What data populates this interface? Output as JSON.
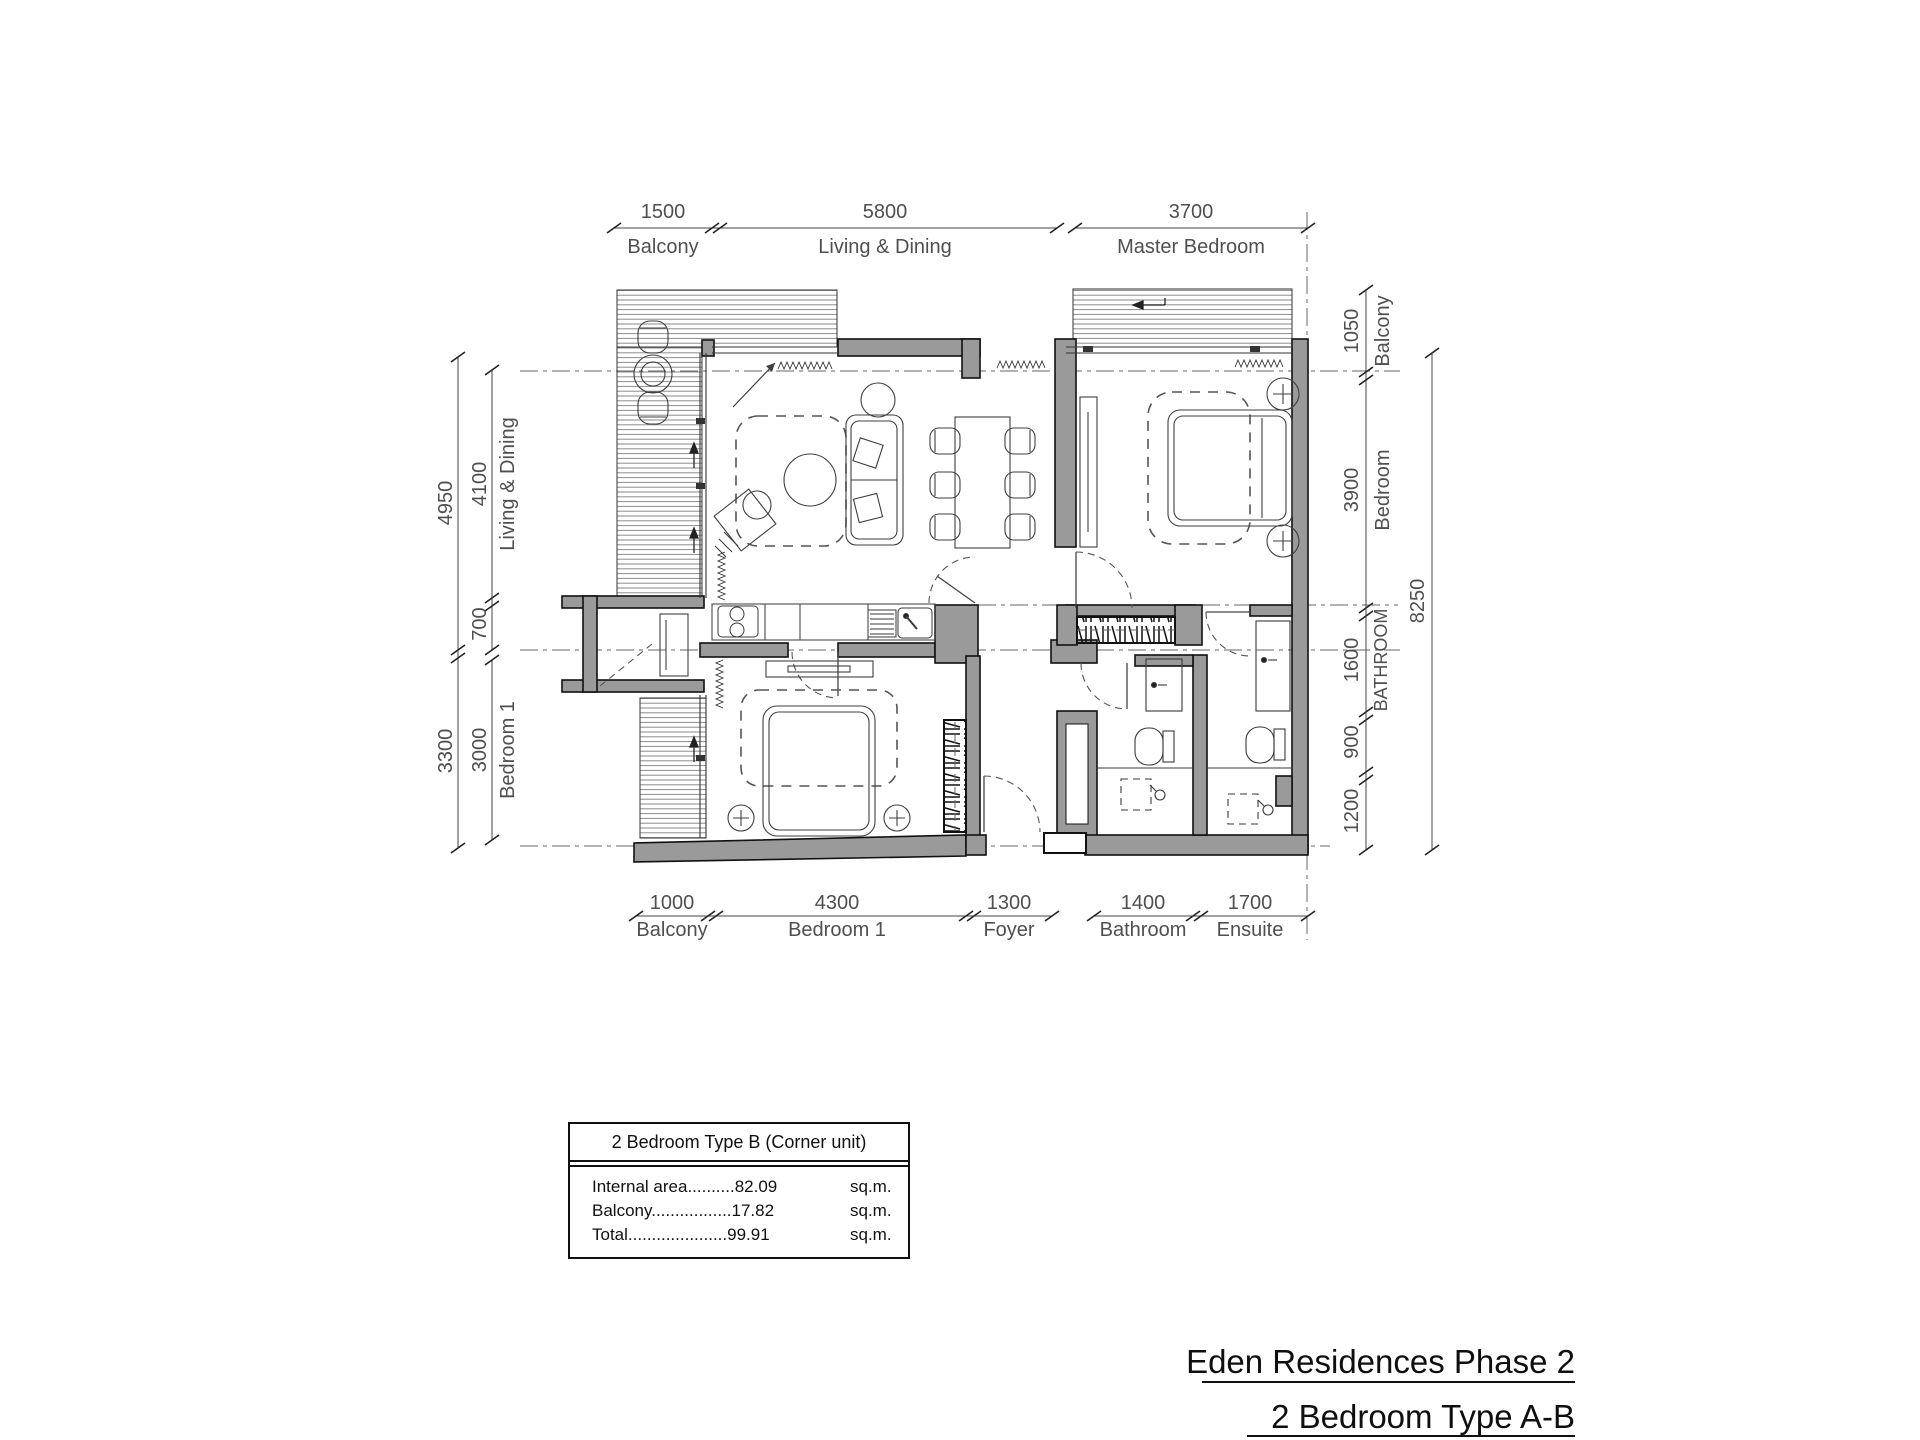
{
  "titles": {
    "project": "Eden Residences Phase 2",
    "unit": "2 Bedroom Type A-B"
  },
  "info_box": {
    "header": "2 Bedroom Type B (Corner unit)",
    "rows": [
      {
        "label": "Internal area",
        "dots": "..........",
        "value": "82.09",
        "unit": "sq.m."
      },
      {
        "label": "Balcony",
        "dots": ".................",
        "value": "17.82",
        "unit": "sq.m."
      },
      {
        "label": "Total",
        "dots": ".....................",
        "value": "99.91",
        "unit": "sq.m."
      }
    ]
  },
  "dims": {
    "top": [
      {
        "value": "1500",
        "label": "Balcony"
      },
      {
        "value": "5800",
        "label": "Living & Dining"
      },
      {
        "value": "3700",
        "label": "Master Bedroom"
      }
    ],
    "bottom": [
      {
        "value": "1000",
        "label": "Balcony"
      },
      {
        "value": "4300",
        "label": "Bedroom 1"
      },
      {
        "value": "1300",
        "label": "Foyer"
      },
      {
        "value": "1400",
        "label": "Bathroom"
      },
      {
        "value": "1700",
        "label": "Ensuite"
      }
    ],
    "left": {
      "outer": [
        {
          "value": "4950"
        },
        {
          "value": "3300"
        }
      ],
      "inner": [
        {
          "value": "4100",
          "label": "Living & Dining"
        },
        {
          "value": "700"
        },
        {
          "value": "3000",
          "label": "Bedroom 1"
        }
      ]
    },
    "right": {
      "inner": [
        {
          "value": "1050",
          "label": "Balcony"
        },
        {
          "value": "3900",
          "label": "Bedroom"
        },
        {
          "value": "1600",
          "label": "BATHROOM"
        },
        {
          "value": "900"
        },
        {
          "value": "1200"
        }
      ],
      "outer": [
        {
          "value": "8250"
        }
      ]
    }
  },
  "colors": {
    "wall_fill": "#9a9a9a",
    "line": "#3a3a3a",
    "dim_text": "#4f4f4f"
  }
}
